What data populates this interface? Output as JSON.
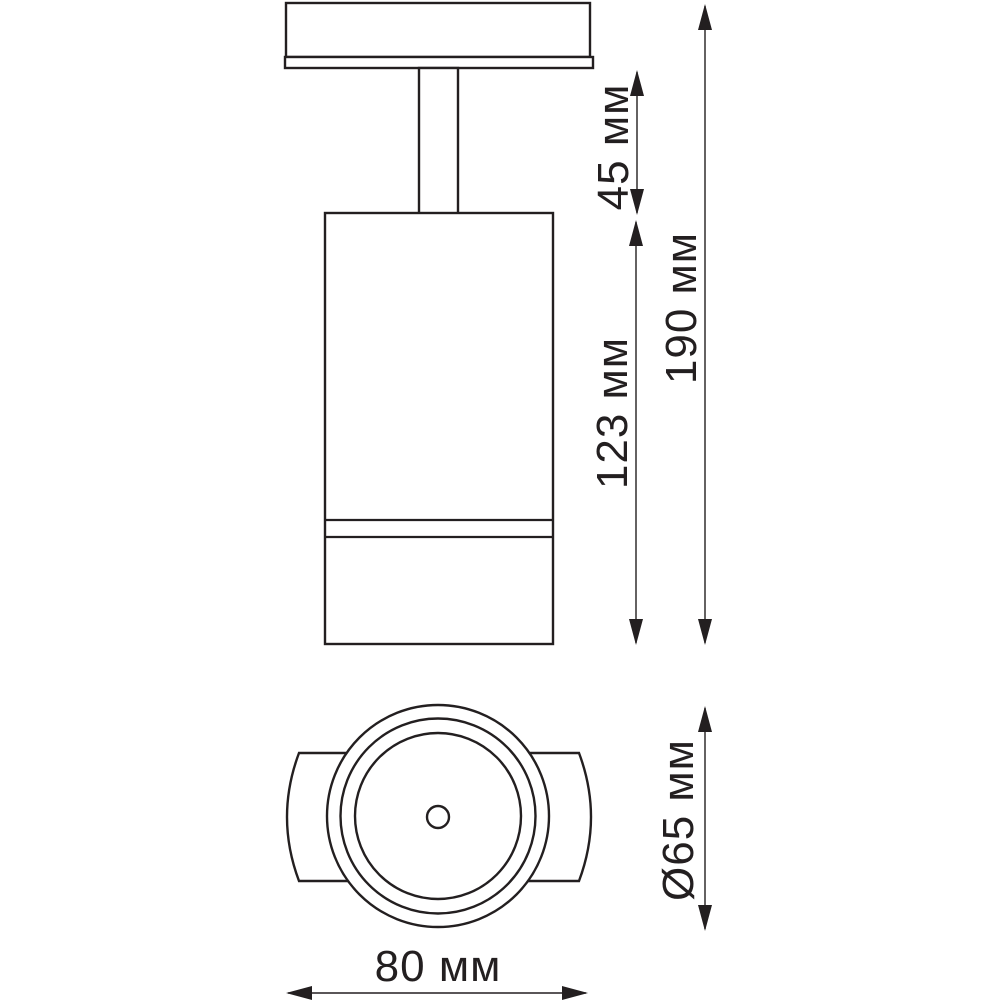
{
  "drawing": {
    "type": "technical-dimension-drawing",
    "subject": "ceiling-spotlight",
    "colors": {
      "line": "#231f20",
      "background": "#ffffff"
    },
    "dimensions": {
      "stem_height": {
        "value": 45,
        "unit": "мм",
        "label": "45 мм"
      },
      "body_height": {
        "value": 123,
        "unit": "мм",
        "label": "123 мм"
      },
      "total_height": {
        "value": 190,
        "unit": "мм",
        "label": "190 мм"
      },
      "diameter": {
        "value": 65,
        "unit": "мм",
        "label": "Ø65 мм"
      },
      "width": {
        "value": 80,
        "unit": "мм",
        "label": "80 мм"
      }
    }
  }
}
